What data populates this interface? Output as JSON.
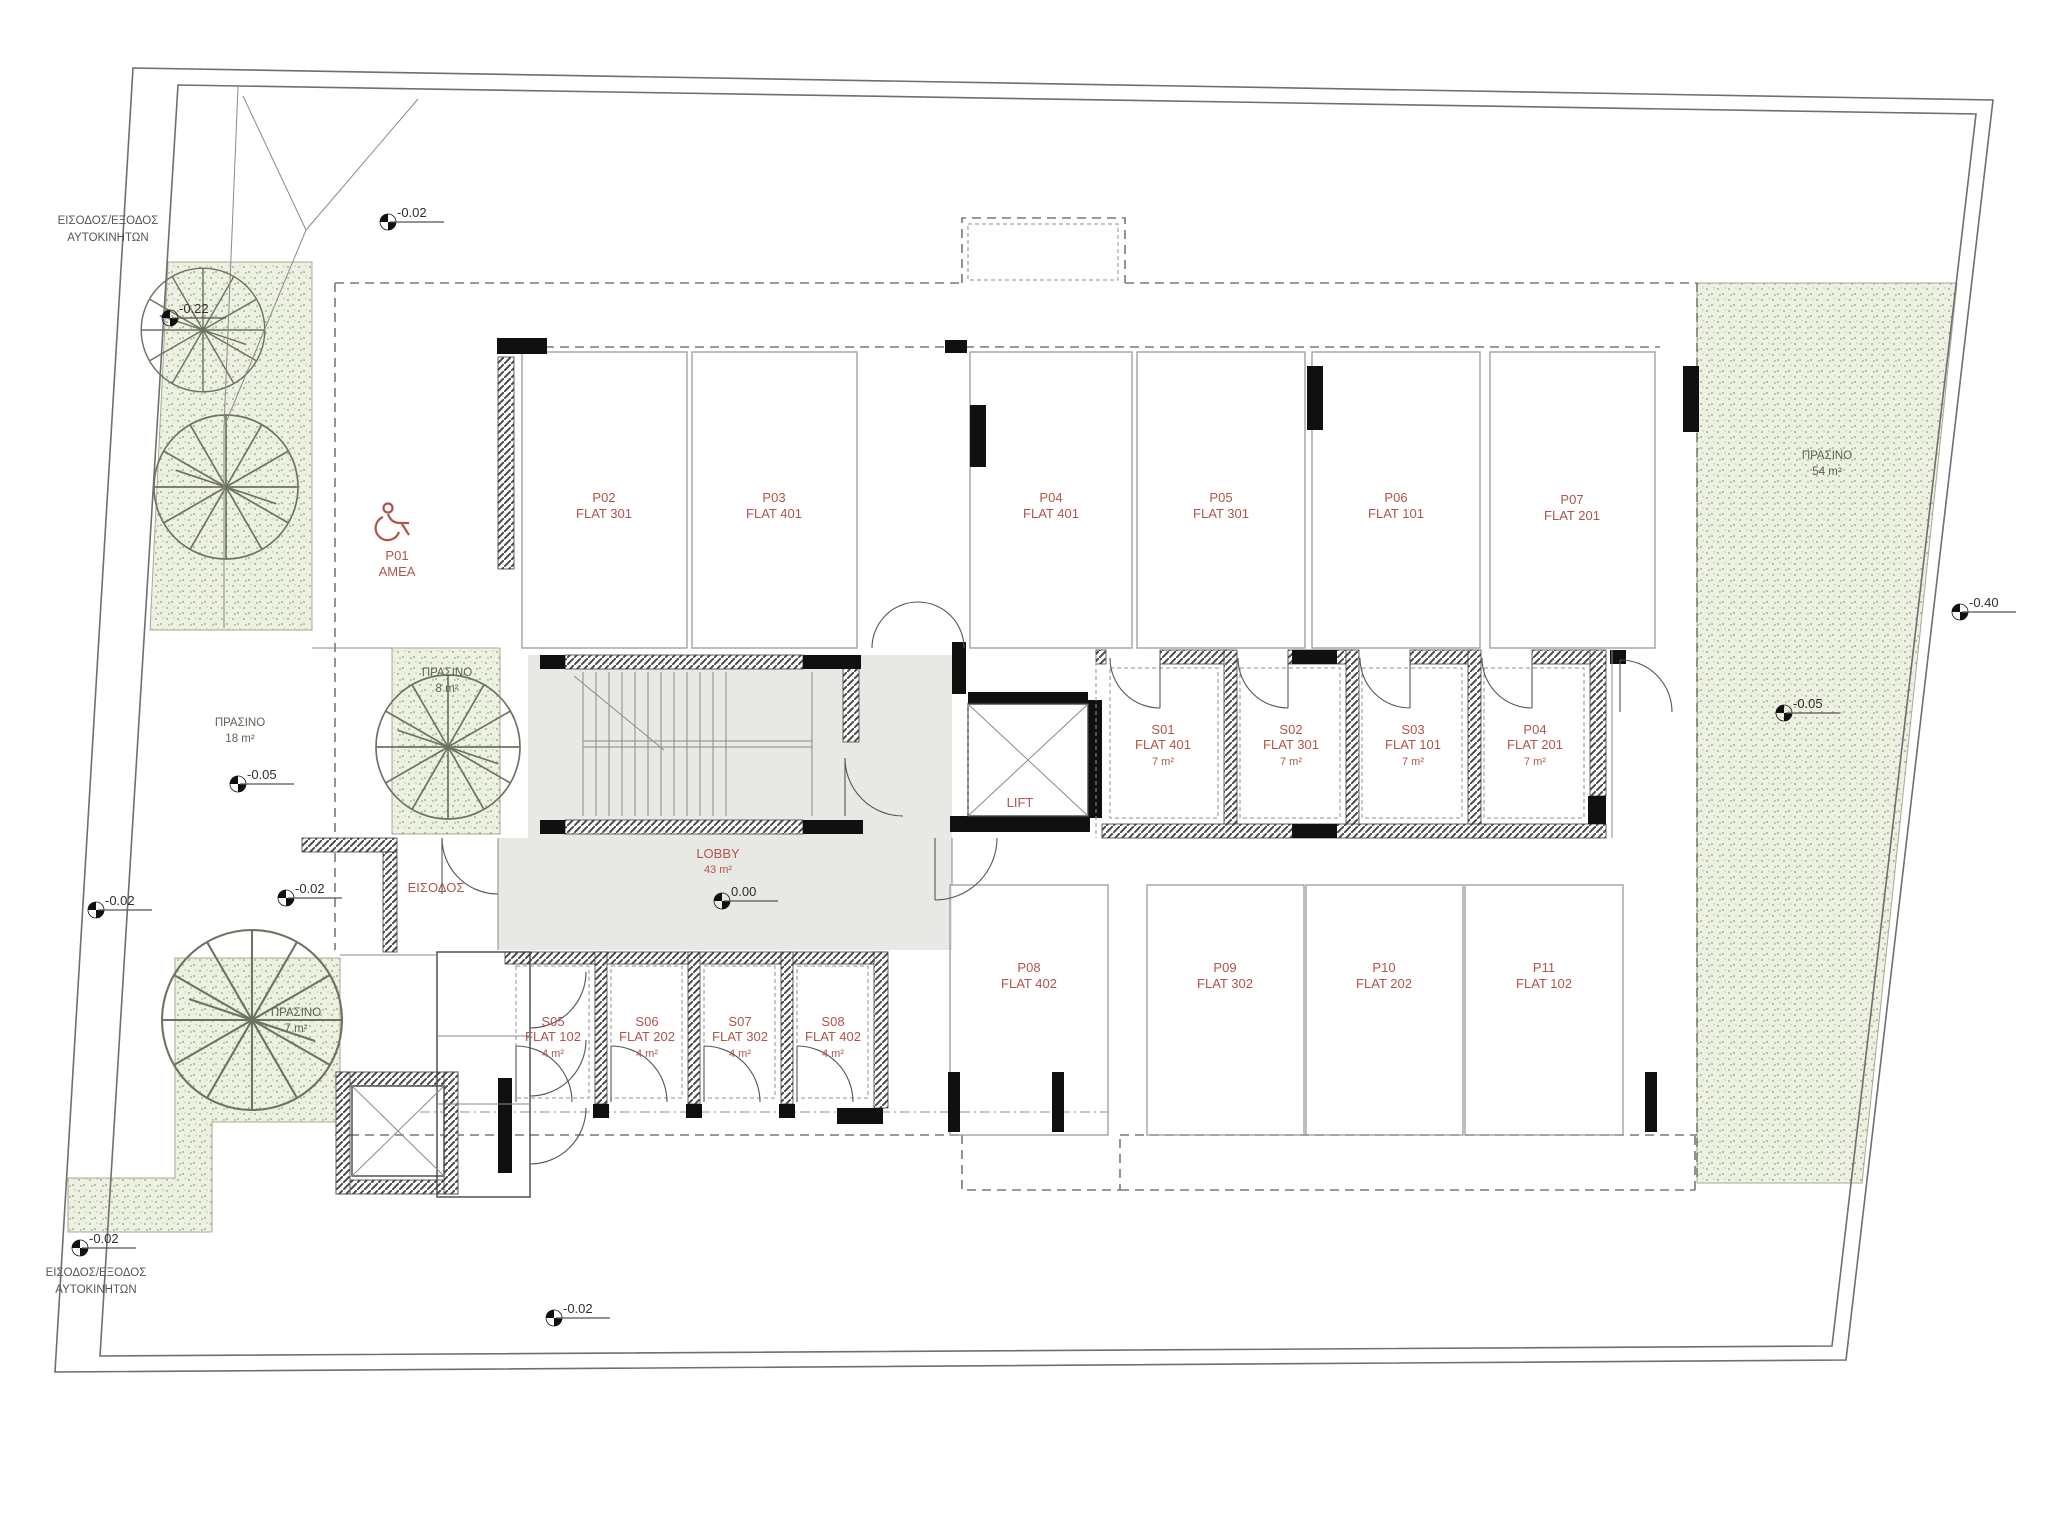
{
  "colors": {
    "label_red": "#b0544a",
    "green_fill": "#edf1e2",
    "lobby_gray": "#e8e8e5",
    "wall_black": "#101010"
  },
  "site": {
    "car_entry_top": {
      "line1": "ΕΙΣΟΔΟΣ/ΕΞΟΔΟΣ",
      "line2": "ΑΥΤΟΚΙΝΗΤΩΝ"
    },
    "car_entry_bottom": {
      "line1": "ΕΙΣΟΔΟΣ/ΕΞΟΔΟΣ",
      "line2": "ΑΥΤΟΚΙΝΗΤΩΝ"
    },
    "entrance_label": "ΕΙΣΟΔΟΣ",
    "lift_label": "LIFT",
    "lobby": {
      "name": "LOBBY",
      "area": "43 m²"
    }
  },
  "levels": {
    "zero": "0.00",
    "minus002": "-0.02",
    "minus005": "-0.05",
    "minus022": "-0.22",
    "minus040": "-0.40"
  },
  "green": {
    "label": "ΠΡΑΣΙΝΟ",
    "left": {
      "area": "18 m²"
    },
    "mid": {
      "area": "8 m²"
    },
    "right": {
      "area": "54 m²"
    },
    "bottom": {
      "area": "7 m²"
    }
  },
  "parking": {
    "p01": {
      "id": "P01",
      "flat": "AMEA"
    },
    "p02": {
      "id": "P02",
      "flat": "FLAT 301"
    },
    "p03": {
      "id": "P03",
      "flat": "FLAT 401"
    },
    "p04": {
      "id": "P04",
      "flat": "FLAT 401"
    },
    "p05": {
      "id": "P05",
      "flat": "FLAT 301"
    },
    "p06": {
      "id": "P06",
      "flat": "FLAT 101"
    },
    "p07": {
      "id": "P07",
      "flat": "FLAT 201"
    },
    "p08": {
      "id": "P08",
      "flat": "FLAT 402"
    },
    "p09": {
      "id": "P09",
      "flat": "FLAT 302"
    },
    "p10": {
      "id": "P10",
      "flat": "FLAT 202"
    },
    "p11": {
      "id": "P11",
      "flat": "FLAT 102"
    }
  },
  "storage": {
    "s01": {
      "id": "S01",
      "flat": "FLAT 401",
      "area": "7 m²"
    },
    "s02": {
      "id": "S02",
      "flat": "FLAT 301",
      "area": "7 m²"
    },
    "s03": {
      "id": "S03",
      "flat": "FLAT 101",
      "area": "7 m²"
    },
    "s04": {
      "id": "P04",
      "flat": "FLAT 201",
      "area": "7 m²"
    },
    "s05": {
      "id": "S05",
      "flat": "FLAT 102",
      "area": "4 m²"
    },
    "s06": {
      "id": "S06",
      "flat": "FLAT 202",
      "area": "4 m²"
    },
    "s07": {
      "id": "S07",
      "flat": "FLAT 302",
      "area": "4 m²"
    },
    "s08": {
      "id": "S08",
      "flat": "FLAT 402",
      "area": "4 m²"
    }
  }
}
